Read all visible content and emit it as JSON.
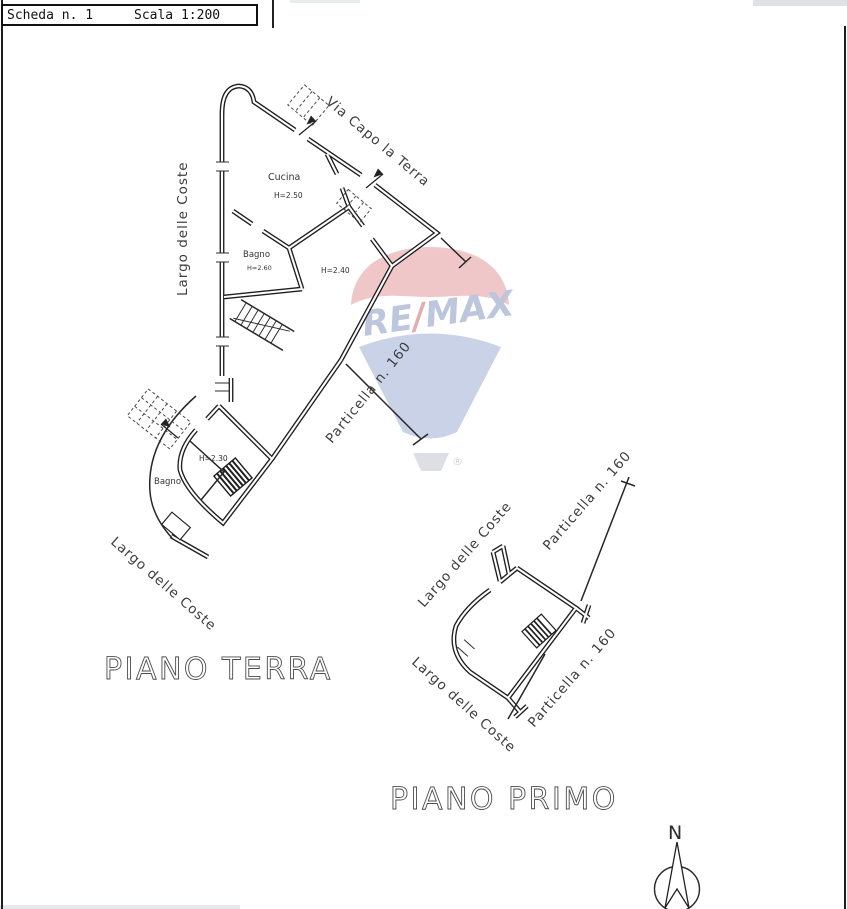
{
  "header": {
    "scheda": "Scheda n. 1",
    "scala": "Scala 1:200"
  },
  "watermark": {
    "brand_re": "RE",
    "brand_slash": "/",
    "brand_max": "MAX",
    "registered": "®",
    "colors": {
      "canopy_red": "#e49a9e",
      "balloon_blue": "#9dafd4",
      "brand_blue": "#8898c3",
      "slash_red": "#c96b72"
    }
  },
  "piano_terra": {
    "title": "PIANO TERRA",
    "via_capo": "Via Capo la Terra",
    "largo_left": "Largo delle Coste",
    "largo_bottom": "Largo delle Coste",
    "particella": "Particella n. 160",
    "rooms": {
      "cucina": "Cucina",
      "cucina_h": "H=2.50",
      "bagno1": "Bagno",
      "bagno1_h": "H=2.60",
      "main_h": "H=2.40",
      "lower_h": "H=2.30",
      "bagno2": "Bagno"
    }
  },
  "piano_primo": {
    "title": "PIANO PRIMO",
    "largo_top": "Largo delle Coste",
    "largo_bottom": "Largo delle Coste",
    "particella_top": "Particella n. 160",
    "particella_bottom": "Particella n. 160"
  },
  "compass": {
    "north": "N"
  },
  "drawing_colors": {
    "wall": "#1f1f1f"
  }
}
